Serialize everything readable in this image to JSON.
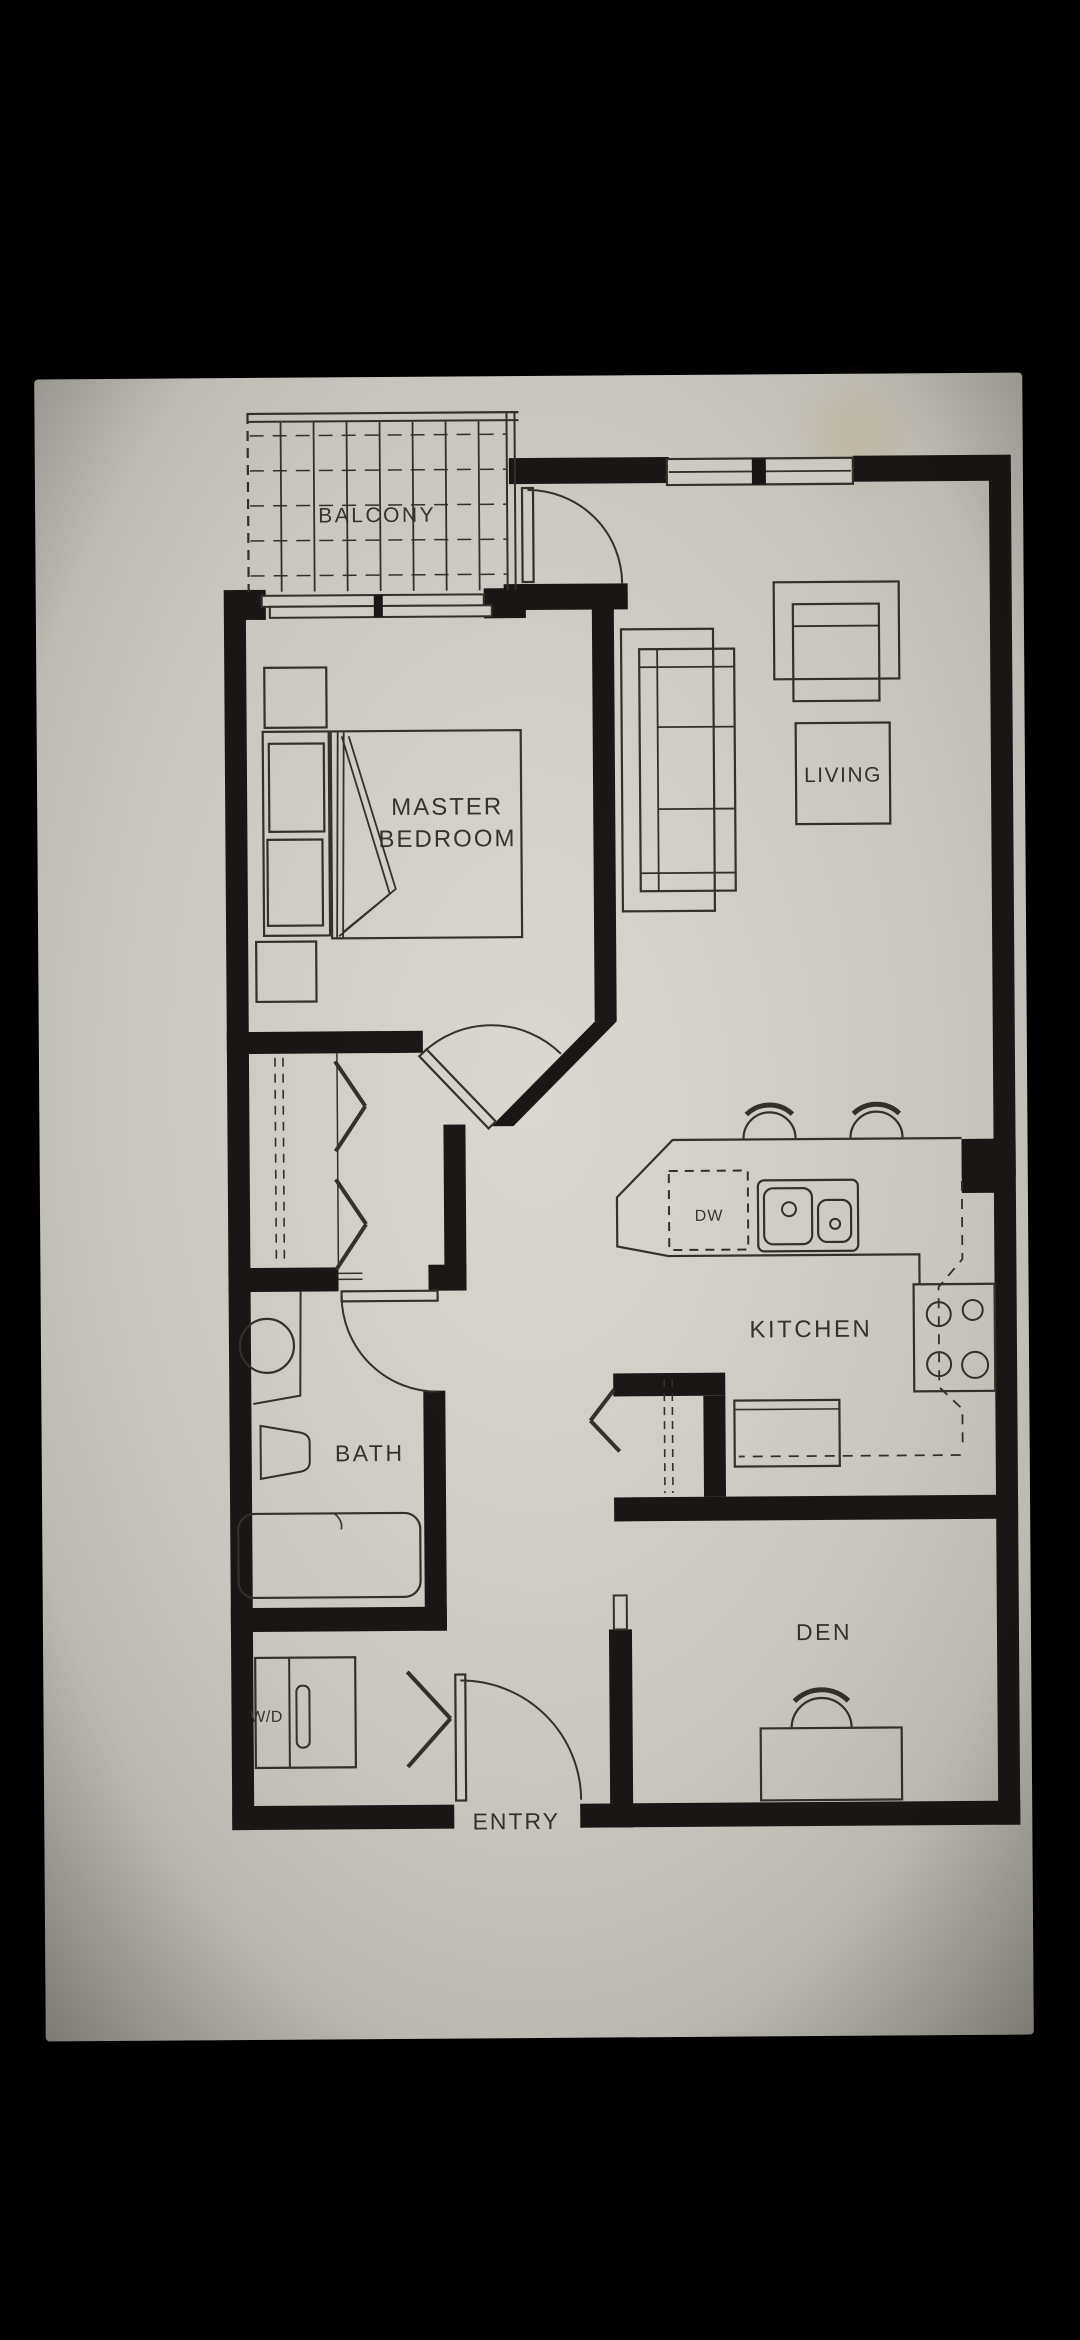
{
  "floor_plan": {
    "rooms": [
      {
        "id": "balcony",
        "label": "BALCONY"
      },
      {
        "id": "master_bedroom",
        "label_line1": "MASTER",
        "label_line2": "BEDROOM"
      },
      {
        "id": "living",
        "label": "LIVING"
      },
      {
        "id": "kitchen",
        "label": "KITCHEN"
      },
      {
        "id": "bath",
        "label": "BATH"
      },
      {
        "id": "den",
        "label": "DEN"
      },
      {
        "id": "entry",
        "label": "ENTRY"
      }
    ],
    "appliances": [
      {
        "id": "dishwasher",
        "label": "DW"
      },
      {
        "id": "washer_dryer",
        "label": "W/D"
      }
    ],
    "colors": {
      "background": "#000000",
      "paper": "#d6d3cc",
      "paper_edge": "#b4b1aa",
      "ink": "#35322c",
      "wall": "#1a1816"
    }
  }
}
